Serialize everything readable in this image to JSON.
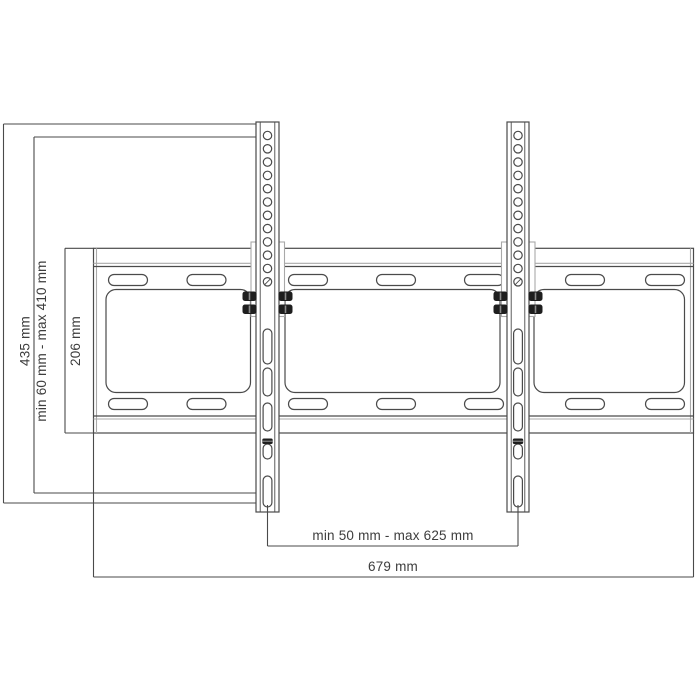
{
  "diagram": {
    "kind": "tv-wall-mount-dimension-drawing",
    "labels": {
      "overall_height": "435 mm",
      "bracket_height_range": "min 60 mm - max 410 mm",
      "plate_height": "206 mm",
      "rail_spacing_range": "min 50 mm - max 625 mm",
      "overall_width": "679 mm"
    },
    "colors": {
      "background": "#ffffff",
      "line": "#4a4a4a",
      "light_line": "#a9a9a9",
      "text": "#3d3d3d",
      "bolt": "#1e1e1e"
    }
  }
}
